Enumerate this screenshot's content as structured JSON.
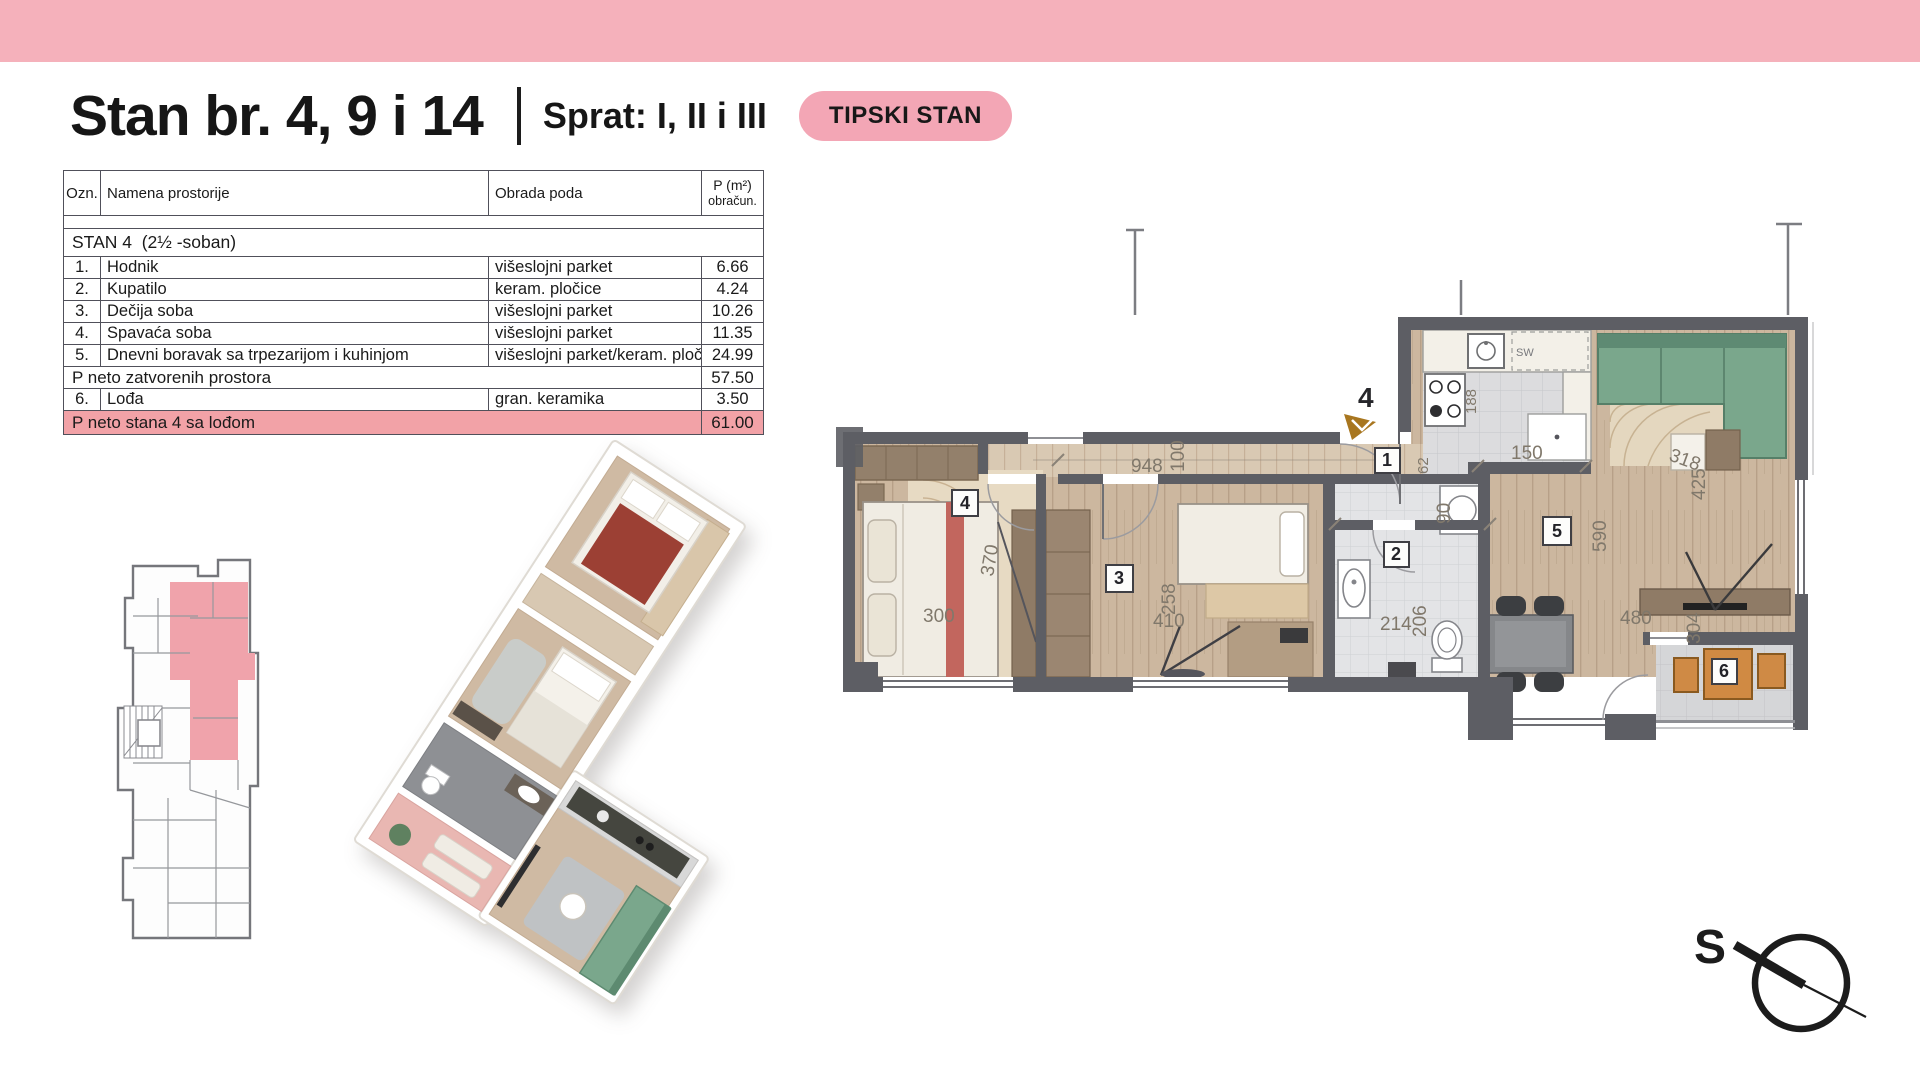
{
  "title": {
    "main": "Stan br. 4, 9 i 14",
    "floor_label": "Sprat: I, II i III",
    "badge": "TIPSKI STAN"
  },
  "table": {
    "col_ozn": "Ozn.",
    "col_name": "Namena prostorije",
    "col_finish": "Obrada poda",
    "col_area_1": "P (m²)",
    "col_area_2": "obračun.",
    "section_name": "STAN 4",
    "section_note": "(2½ -soban)",
    "rows": [
      {
        "ozn": "1.",
        "name": "Hodnik",
        "finish": "višeslojni parket",
        "area": "6.66"
      },
      {
        "ozn": "2.",
        "name": "Kupatilo",
        "finish": "keram. pločice",
        "area": "4.24"
      },
      {
        "ozn": "3.",
        "name": "Dečija soba",
        "finish": "višeslojni parket",
        "area": "10.26"
      },
      {
        "ozn": "4.",
        "name": "Spavaća soba",
        "finish": "višeslojni parket",
        "area": "11.35"
      },
      {
        "ozn": "5.",
        "name": "Dnevni boravak sa trpezarijom i kuhinjom",
        "finish": "višeslojni parket/keram. ploč.",
        "area": "24.99"
      }
    ],
    "subtotal": {
      "label": "P neto zatvorenih prostora",
      "area": "57.50"
    },
    "row6": {
      "ozn": "6.",
      "name": "Lođa",
      "finish": "gran. keramika",
      "area": "3.50"
    },
    "total": {
      "label": "P neto stana 4 sa lođom",
      "area": "61.00"
    }
  },
  "plan2d": {
    "entrance": "4",
    "rooms": {
      "r1": "1",
      "r2": "2",
      "r3": "3",
      "r4": "4",
      "r5": "5",
      "r6": "6"
    },
    "dims": {
      "d948": "948",
      "d100": "100",
      "d300": "300",
      "d370": "370",
      "d410": "410",
      "d258": "258",
      "d62": "62",
      "d90": "90",
      "d214": "214",
      "d206": "206",
      "d150": "150",
      "d590": "590",
      "d425": "425",
      "d318": "318",
      "d480": "480",
      "d304": "304",
      "d188": "188"
    },
    "kitchen_sink": "SW"
  },
  "compass": {
    "label": "S"
  },
  "colors": {
    "accent_pink": "#f5b1bb",
    "highlight_row": "#f2a2a7",
    "wall_gray": "#5d5e64",
    "sofa_green": "#7aa78c",
    "loggia_orange": "#d08a43"
  }
}
